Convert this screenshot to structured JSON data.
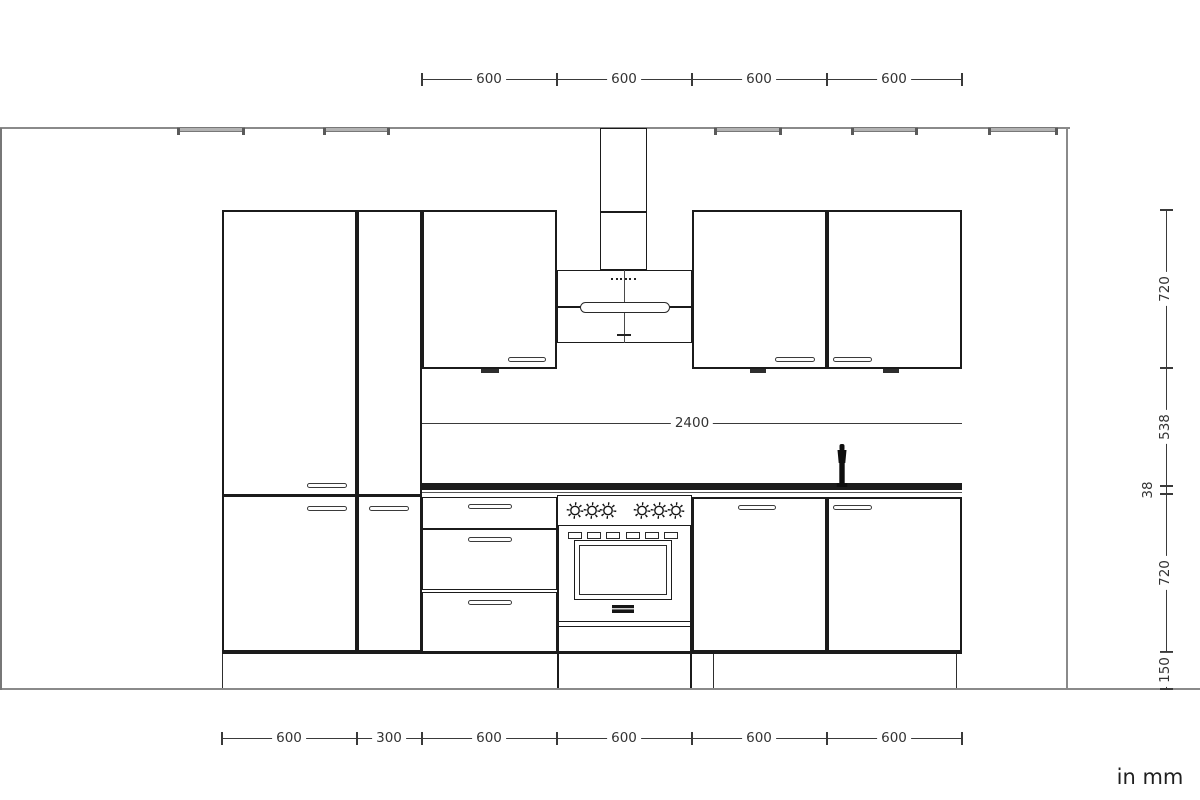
{
  "drawing": {
    "unit_note": "in mm",
    "dims": {
      "top": [
        "600",
        "600",
        "600",
        "600"
      ],
      "bottom": [
        "600",
        "300",
        "600",
        "600",
        "600",
        "600"
      ],
      "right": [
        "720",
        "538",
        "38",
        "720",
        "150"
      ],
      "run_total": "2400"
    },
    "colors": {
      "cabinet_line": "#1b1b1b",
      "dimension_line": "#3a3a3a",
      "wall_line": "#8a8a8a",
      "countertop": "#1c1c1c",
      "ceiling_light": "#b3b3b3"
    }
  }
}
